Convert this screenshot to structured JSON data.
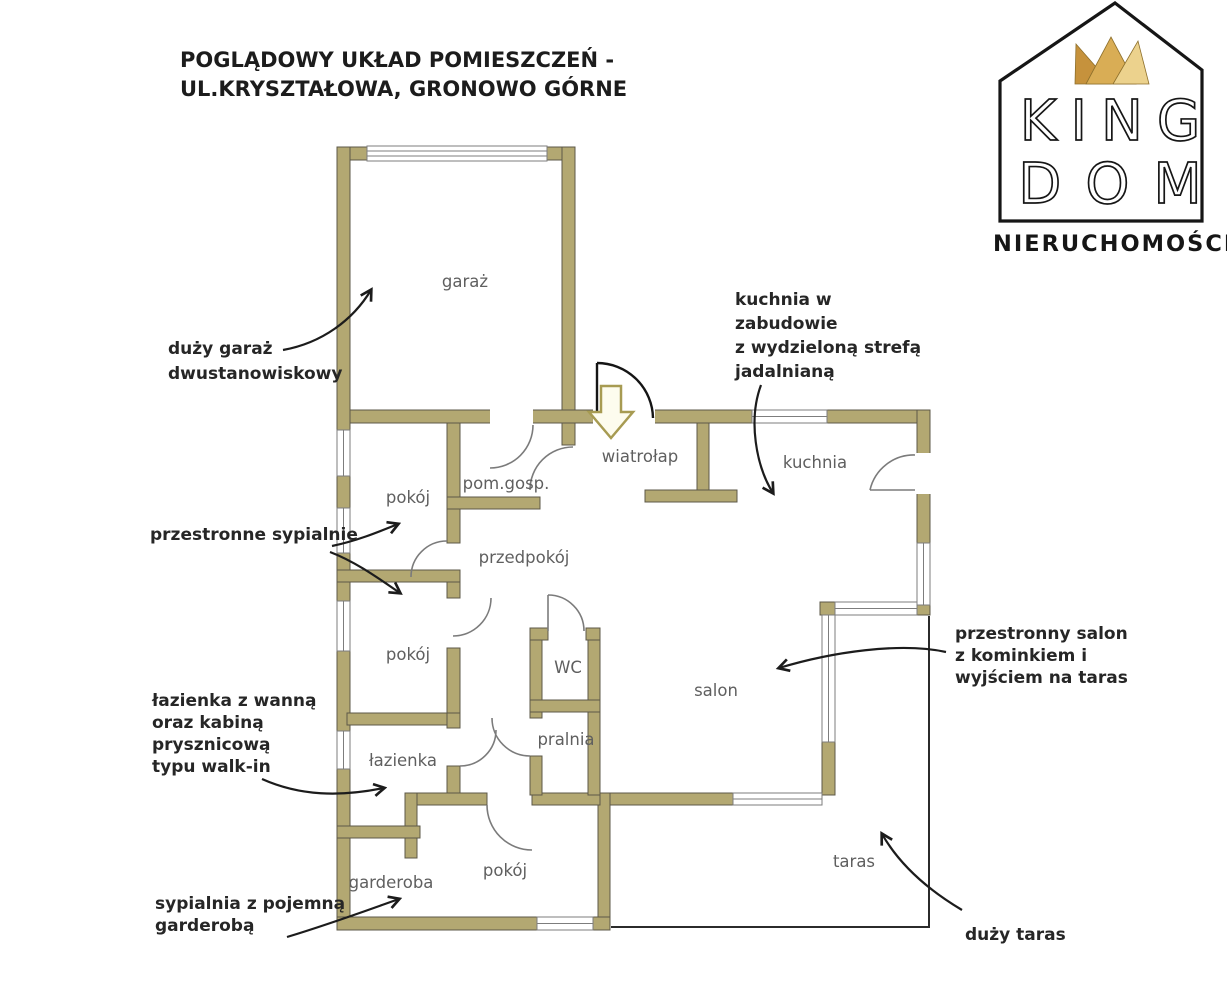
{
  "title": {
    "line1": "POGLĄDOWY UKŁAD POMIESZCZEŃ -",
    "line2": "UL.KRYSZTAŁOWA, GRONOWO GÓRNE"
  },
  "logo": {
    "name_line1": "KING",
    "name_line2": "DOM",
    "subtitle": "NIERUCHOMOŚCI"
  },
  "colors": {
    "wall": "#b3a872",
    "crown_dark": "#c6923c",
    "crown_mid": "#d9ad55",
    "crown_light": "#ecd28d",
    "annotation_text": "#262626",
    "room_label": "#5f5f5f"
  },
  "rooms": [
    {
      "id": "garaz",
      "label": "garaż"
    },
    {
      "id": "pokoj-1",
      "label": "pokój"
    },
    {
      "id": "pom-gosp",
      "label": "pom.gosp."
    },
    {
      "id": "wiatrolap",
      "label": "wiatrołap"
    },
    {
      "id": "kuchnia",
      "label": "kuchnia"
    },
    {
      "id": "przedpokoj",
      "label": "przedpokój"
    },
    {
      "id": "pokoj-2",
      "label": "pokój"
    },
    {
      "id": "wc",
      "label": "WC"
    },
    {
      "id": "salon",
      "label": "salon"
    },
    {
      "id": "lazienka",
      "label": "łazienka"
    },
    {
      "id": "pralnia",
      "label": "pralnia"
    },
    {
      "id": "garderoba",
      "label": "garderoba"
    },
    {
      "id": "pokoj-3",
      "label": "pokój"
    },
    {
      "id": "taras",
      "label": "taras"
    }
  ],
  "annotations": [
    {
      "id": "garaz",
      "lines": [
        "duży garaż",
        "dwustanowiskowy"
      ]
    },
    {
      "id": "sypialnie",
      "lines": [
        "przestronne sypialnie"
      ]
    },
    {
      "id": "lazienka",
      "lines": [
        "łazienka z wanną",
        "oraz kabiną",
        "prysznicową",
        "typu walk-in"
      ]
    },
    {
      "id": "garderoba",
      "lines": [
        "sypialnia z pojemną",
        "garderobą"
      ]
    },
    {
      "id": "kuchnia",
      "lines": [
        "kuchnia w",
        "zabudowie",
        "z wydzieloną strefą",
        "jadalnianą"
      ]
    },
    {
      "id": "salon",
      "lines": [
        "przestronny salon",
        "z kominkiem i",
        "wyjściem na taras"
      ]
    },
    {
      "id": "taras",
      "lines": [
        "duży taras"
      ]
    }
  ]
}
